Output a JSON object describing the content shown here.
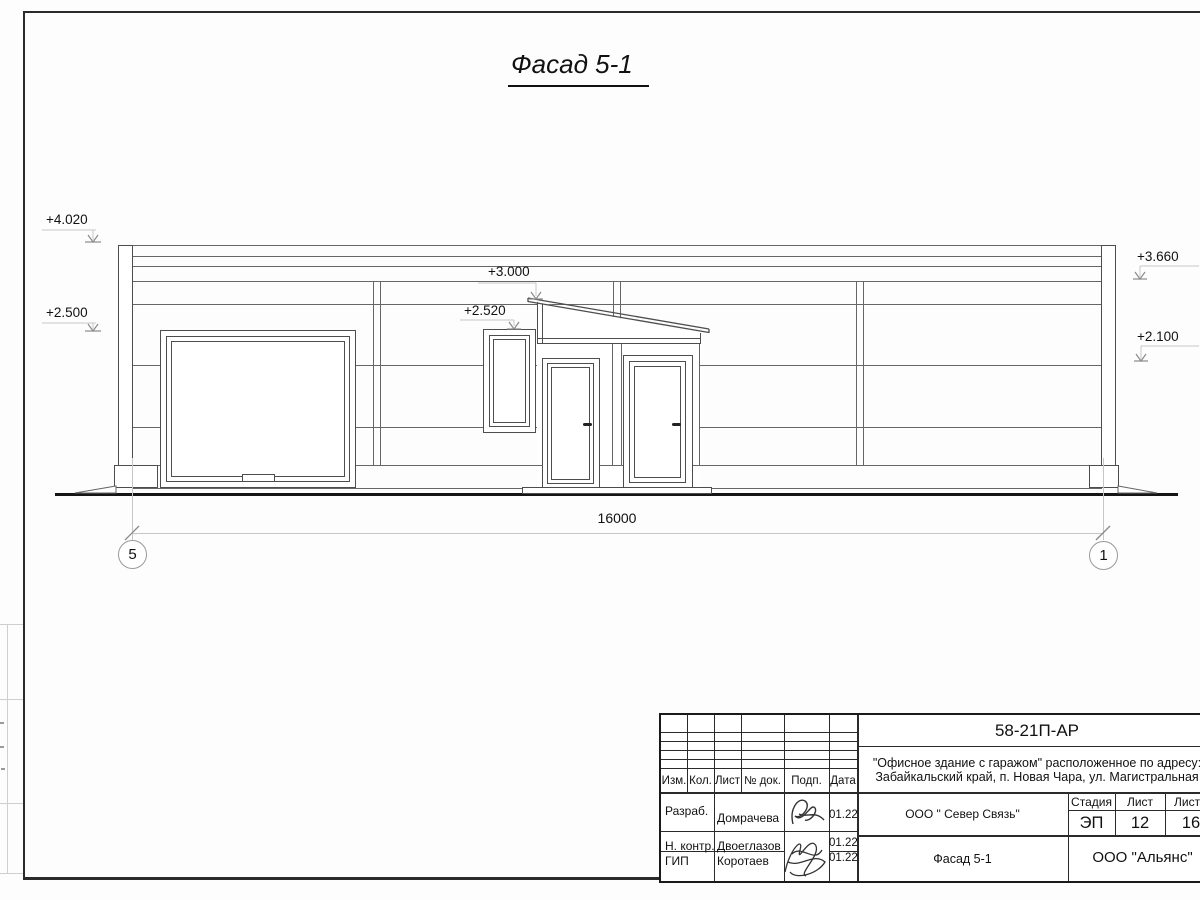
{
  "sheet": {
    "title": "Фасад 5-1"
  },
  "facade": {
    "elevation_marks": {
      "left_top": "+4.020",
      "left_mid": "+2.500",
      "canopy": "+3.000",
      "window": "+2.520",
      "right_top": "+3.660",
      "right_mid": "+2.100"
    },
    "dimension_total": "16000",
    "axes": {
      "left": "5",
      "right": "1"
    }
  },
  "title_block": {
    "document_code": "58-21П-АР",
    "project_name_line1": "\"Офисное здание с гаражом\" расположенное по адресу:",
    "project_name_line2": "Забайкальский край, п. Новая Чара, ул. Магистральная",
    "revision_headers": {
      "izm": "Изм.",
      "kol": "Кол.",
      "list": "Лист",
      "doc": "№ док.",
      "podp": "Подп.",
      "data": "Дата"
    },
    "signers": [
      {
        "role": "Разраб.",
        "name": "Домрачева",
        "date": "01.22"
      },
      {
        "role": "Н. контр.",
        "name": "Двоеглазов",
        "date": "01.22"
      },
      {
        "role": "ГИП",
        "name": "Коротаев",
        "date": "01.22"
      }
    ],
    "contractor": "ООО \" Север Связь\"",
    "stage_header": "Стадия",
    "sheet_header": "Лист",
    "sheets_header": "Листов",
    "stage": "ЭП",
    "sheet_number": "12",
    "sheets_total": "16",
    "view_title": "Фасад 5-1",
    "company": "ООО \"Альянс\""
  }
}
